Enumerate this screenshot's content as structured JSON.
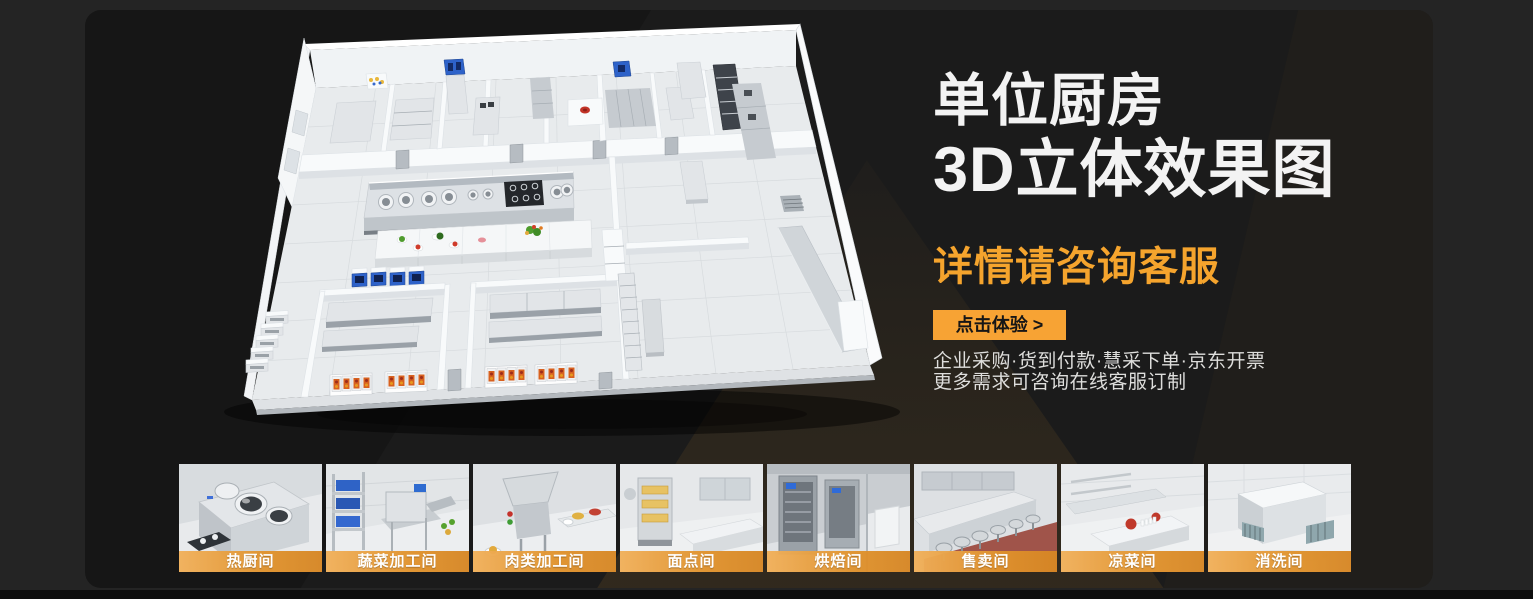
{
  "hero": {
    "title_line1": "单位厨房",
    "title_line2": "3D立体效果图",
    "subtitle": "详情请咨询客服",
    "cta_label": "点击体验 >",
    "desc_line1": "企业采购·货到付款·慧采下单·京东开票",
    "desc_line2": "更多需求可咨询在线客服订制"
  },
  "colors": {
    "accent_orange": "#F5A42D",
    "button_orange": "#F7A334",
    "panel_bg": "#1B1B1B",
    "page_bg": "#242424",
    "title_white": "#F3F3F3"
  },
  "gallery": {
    "items": [
      {
        "label": "热厨间"
      },
      {
        "label": "蔬菜加工间"
      },
      {
        "label": "肉类加工间"
      },
      {
        "label": "面点间"
      },
      {
        "label": "烘焙间"
      },
      {
        "label": "售卖间"
      },
      {
        "label": "凉菜间"
      },
      {
        "label": "消洗间"
      }
    ]
  }
}
